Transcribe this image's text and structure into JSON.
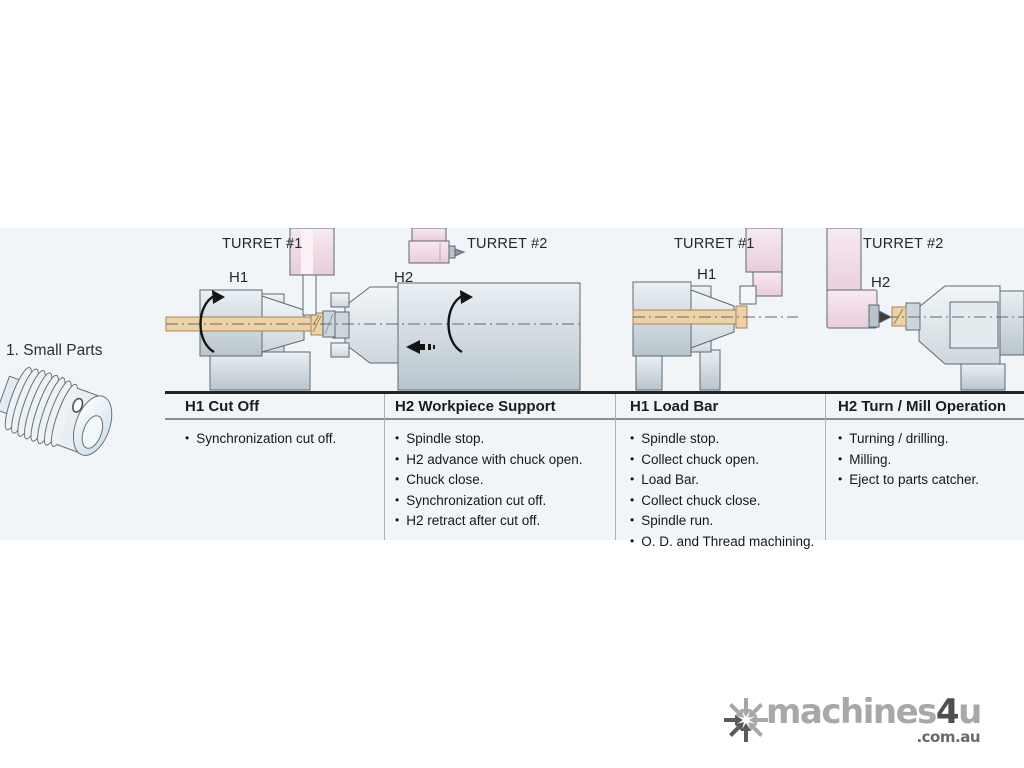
{
  "section": {
    "label": "1. Small Parts"
  },
  "diagram": {
    "panel1": {
      "turret1": "TURRET #1",
      "turret2": "TURRET #2",
      "h1": "H1",
      "h2": "H2"
    },
    "panel2": {
      "turret1": "TURRET #1",
      "turret2": "TURRET #2",
      "h1": "H1",
      "h2": "H2"
    }
  },
  "table": {
    "columns": [
      {
        "header": "H1 Cut Off",
        "bullets": [
          "Synchronization cut off."
        ]
      },
      {
        "header": "H2 Workpiece Support",
        "bullets": [
          "Spindle stop.",
          "H2 advance with chuck open.",
          "Chuck close.",
          "Synchronization cut off.",
          "H2 retract after cut off."
        ]
      },
      {
        "header": "H1 Load Bar",
        "bullets": [
          "Spindle stop.",
          "Collect chuck open.",
          "Load Bar.",
          "Collect chuck close.",
          "Spindle run.",
          "O. D. and Thread machining."
        ]
      },
      {
        "header": "H2 Turn / Mill Operation",
        "bullets": [
          "Turning / drilling.",
          "Milling.",
          "Eject to parts catcher."
        ]
      }
    ]
  },
  "watermark": {
    "brand_prefix": "machines",
    "brand_accent": "4",
    "brand_suffix": "u",
    "brand_domain": ".com.au",
    "icon": "snowflake-icon"
  },
  "colors": {
    "band": "#f1f5f8",
    "machine_stroke": "#5d6972",
    "turret_pink": "#f4dfe9",
    "bar_tan": "#eed2a6",
    "table_line": "#1f2226",
    "watermark_gray": "#a8a8a8"
  }
}
